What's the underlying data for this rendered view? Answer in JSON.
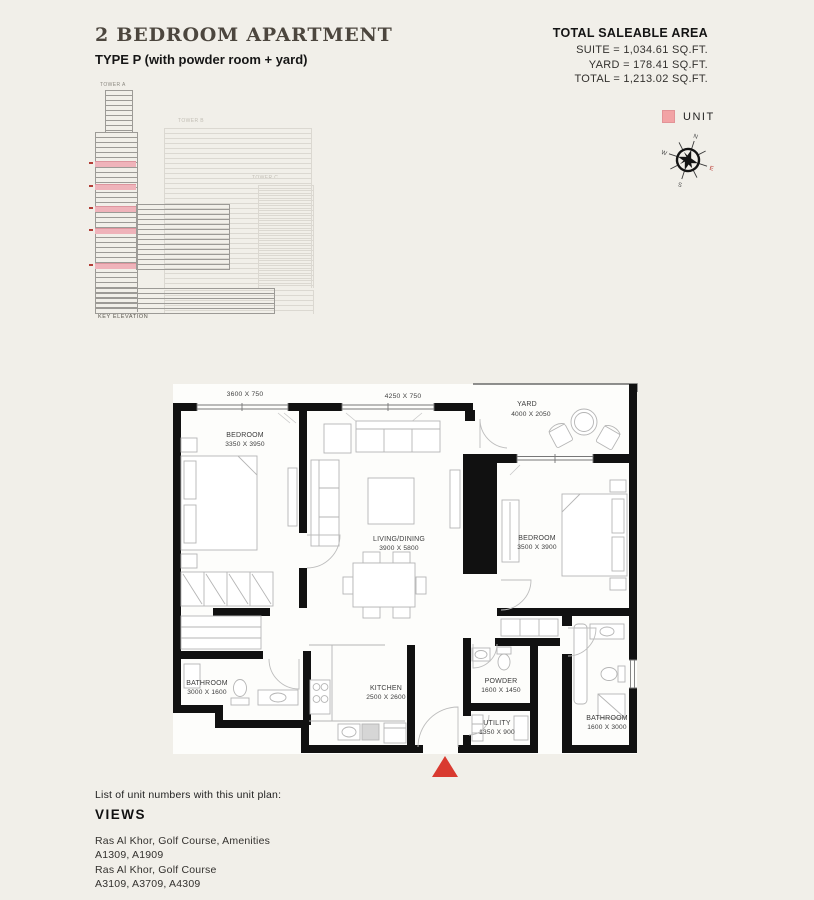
{
  "header": {
    "title": "2 BEDROOM APARTMENT",
    "subtitle": "TYPE P (with powder room + yard)"
  },
  "area_summary": {
    "heading": "TOTAL SALEABLE AREA",
    "suite": "SUITE = 1,034.61 SQ.FT.",
    "yard": "YARD = 178.41 SQ.FT.",
    "total": "TOTAL = 1,213.02 SQ.FT."
  },
  "legend": {
    "unit_label": "UNIT",
    "unit_color": "#f2a3a5"
  },
  "compass": {
    "north": "N",
    "east": "E",
    "south": "S",
    "west": "W",
    "east_color": "#b8342c"
  },
  "key_elevation": {
    "caption": "KEY ELEVATION",
    "tower_a": "TOWER A",
    "tower_b": "TOWER B",
    "tower_c": "TOWER C",
    "highlight_color": "#efb3ba"
  },
  "floor_plan": {
    "entrance_marker_color": "#d93a30",
    "wall_color": "#111111",
    "dimensions": {
      "left": "3600 X 750",
      "middle": "4250 X 750"
    },
    "rooms": [
      {
        "name": "BEDROOM",
        "size": "3350 X 3950"
      },
      {
        "name": "LIVING/DINING",
        "size": "3900 X 5800"
      },
      {
        "name": "YARD",
        "size": "4000 X 2050"
      },
      {
        "name": "BEDROOM",
        "size": "3500 X 3900"
      },
      {
        "name": "BATHROOM",
        "size": "3000 X 1600"
      },
      {
        "name": "KITCHEN",
        "size": "2500 X 2600"
      },
      {
        "name": "POWDER",
        "size": "1600 X 1450"
      },
      {
        "name": "UTILITY",
        "size": "1350 X 900"
      },
      {
        "name": "BATHROOM",
        "size": "1600 X 3000"
      }
    ]
  },
  "footer": {
    "intro": "List of unit numbers with this unit plan:",
    "heading": "VIEWS",
    "views": [
      {
        "description": "Ras Al Khor, Golf Course, Amenities",
        "units": "A1309, A1909"
      },
      {
        "description": "Ras Al Khor, Golf Course",
        "units": "A3109, A3709, A4309"
      }
    ]
  }
}
